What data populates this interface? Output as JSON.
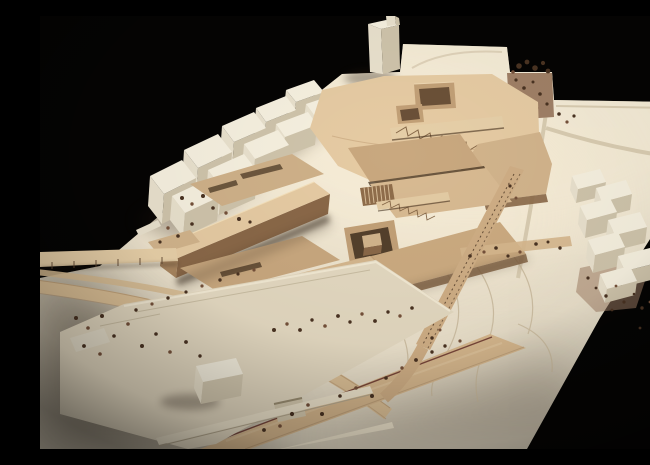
{
  "scene": {
    "type": "photograph",
    "subject": "Architectural scale model, aerial studio photograph",
    "description": "Bird's-eye photograph of a wooden architectural site model on a black background: a central complex of tan basswood buildings with sunken courtyards and truss bridges, surrounded by white context building blocks, a curved access ramp, tree-lined boulevards, a diagonal promenade and contoured white terrain.",
    "background": "#050403"
  },
  "palette": {
    "background": "#050403",
    "base": "#e7dec9",
    "base_bright": "#f4eddb",
    "base_shadow": "#b9ab92",
    "white_top": "#f6f0df",
    "white_front": "#e9e1cd",
    "white_side": "#cfc4ab",
    "wood_light": "#e6cba3",
    "wood_mid": "#d2b48c",
    "wood_deep": "#c2a077",
    "wood_dark": "#8a6848",
    "wood_shadow": "#43301e",
    "courtyard": "#6b5138",
    "planting": "#a08066",
    "tree": "#4a3322",
    "tree_light": "#75513a",
    "road": "#d6b78d",
    "road_edge": "#6e3a30",
    "contour": "#cbbb9e"
  },
  "elements": {
    "model_base": "Cream model base board",
    "tower": "White high-rise block",
    "context_left": "White context building cluster",
    "context_right": "White stepped building cluster",
    "main_complex": "Tan basswood building complex",
    "courtyards": "Recessed courtyards",
    "bridges": "Truss bridges",
    "ramp": "Curved access ramp",
    "walkway": "Elevated walkway",
    "boulevard": "Tree-lined boulevard",
    "promenade": "Diagonal promenade",
    "podium": "White podium building",
    "terrain": "Contoured terrain",
    "planting": "Planting patch",
    "trees": "Model trees"
  }
}
